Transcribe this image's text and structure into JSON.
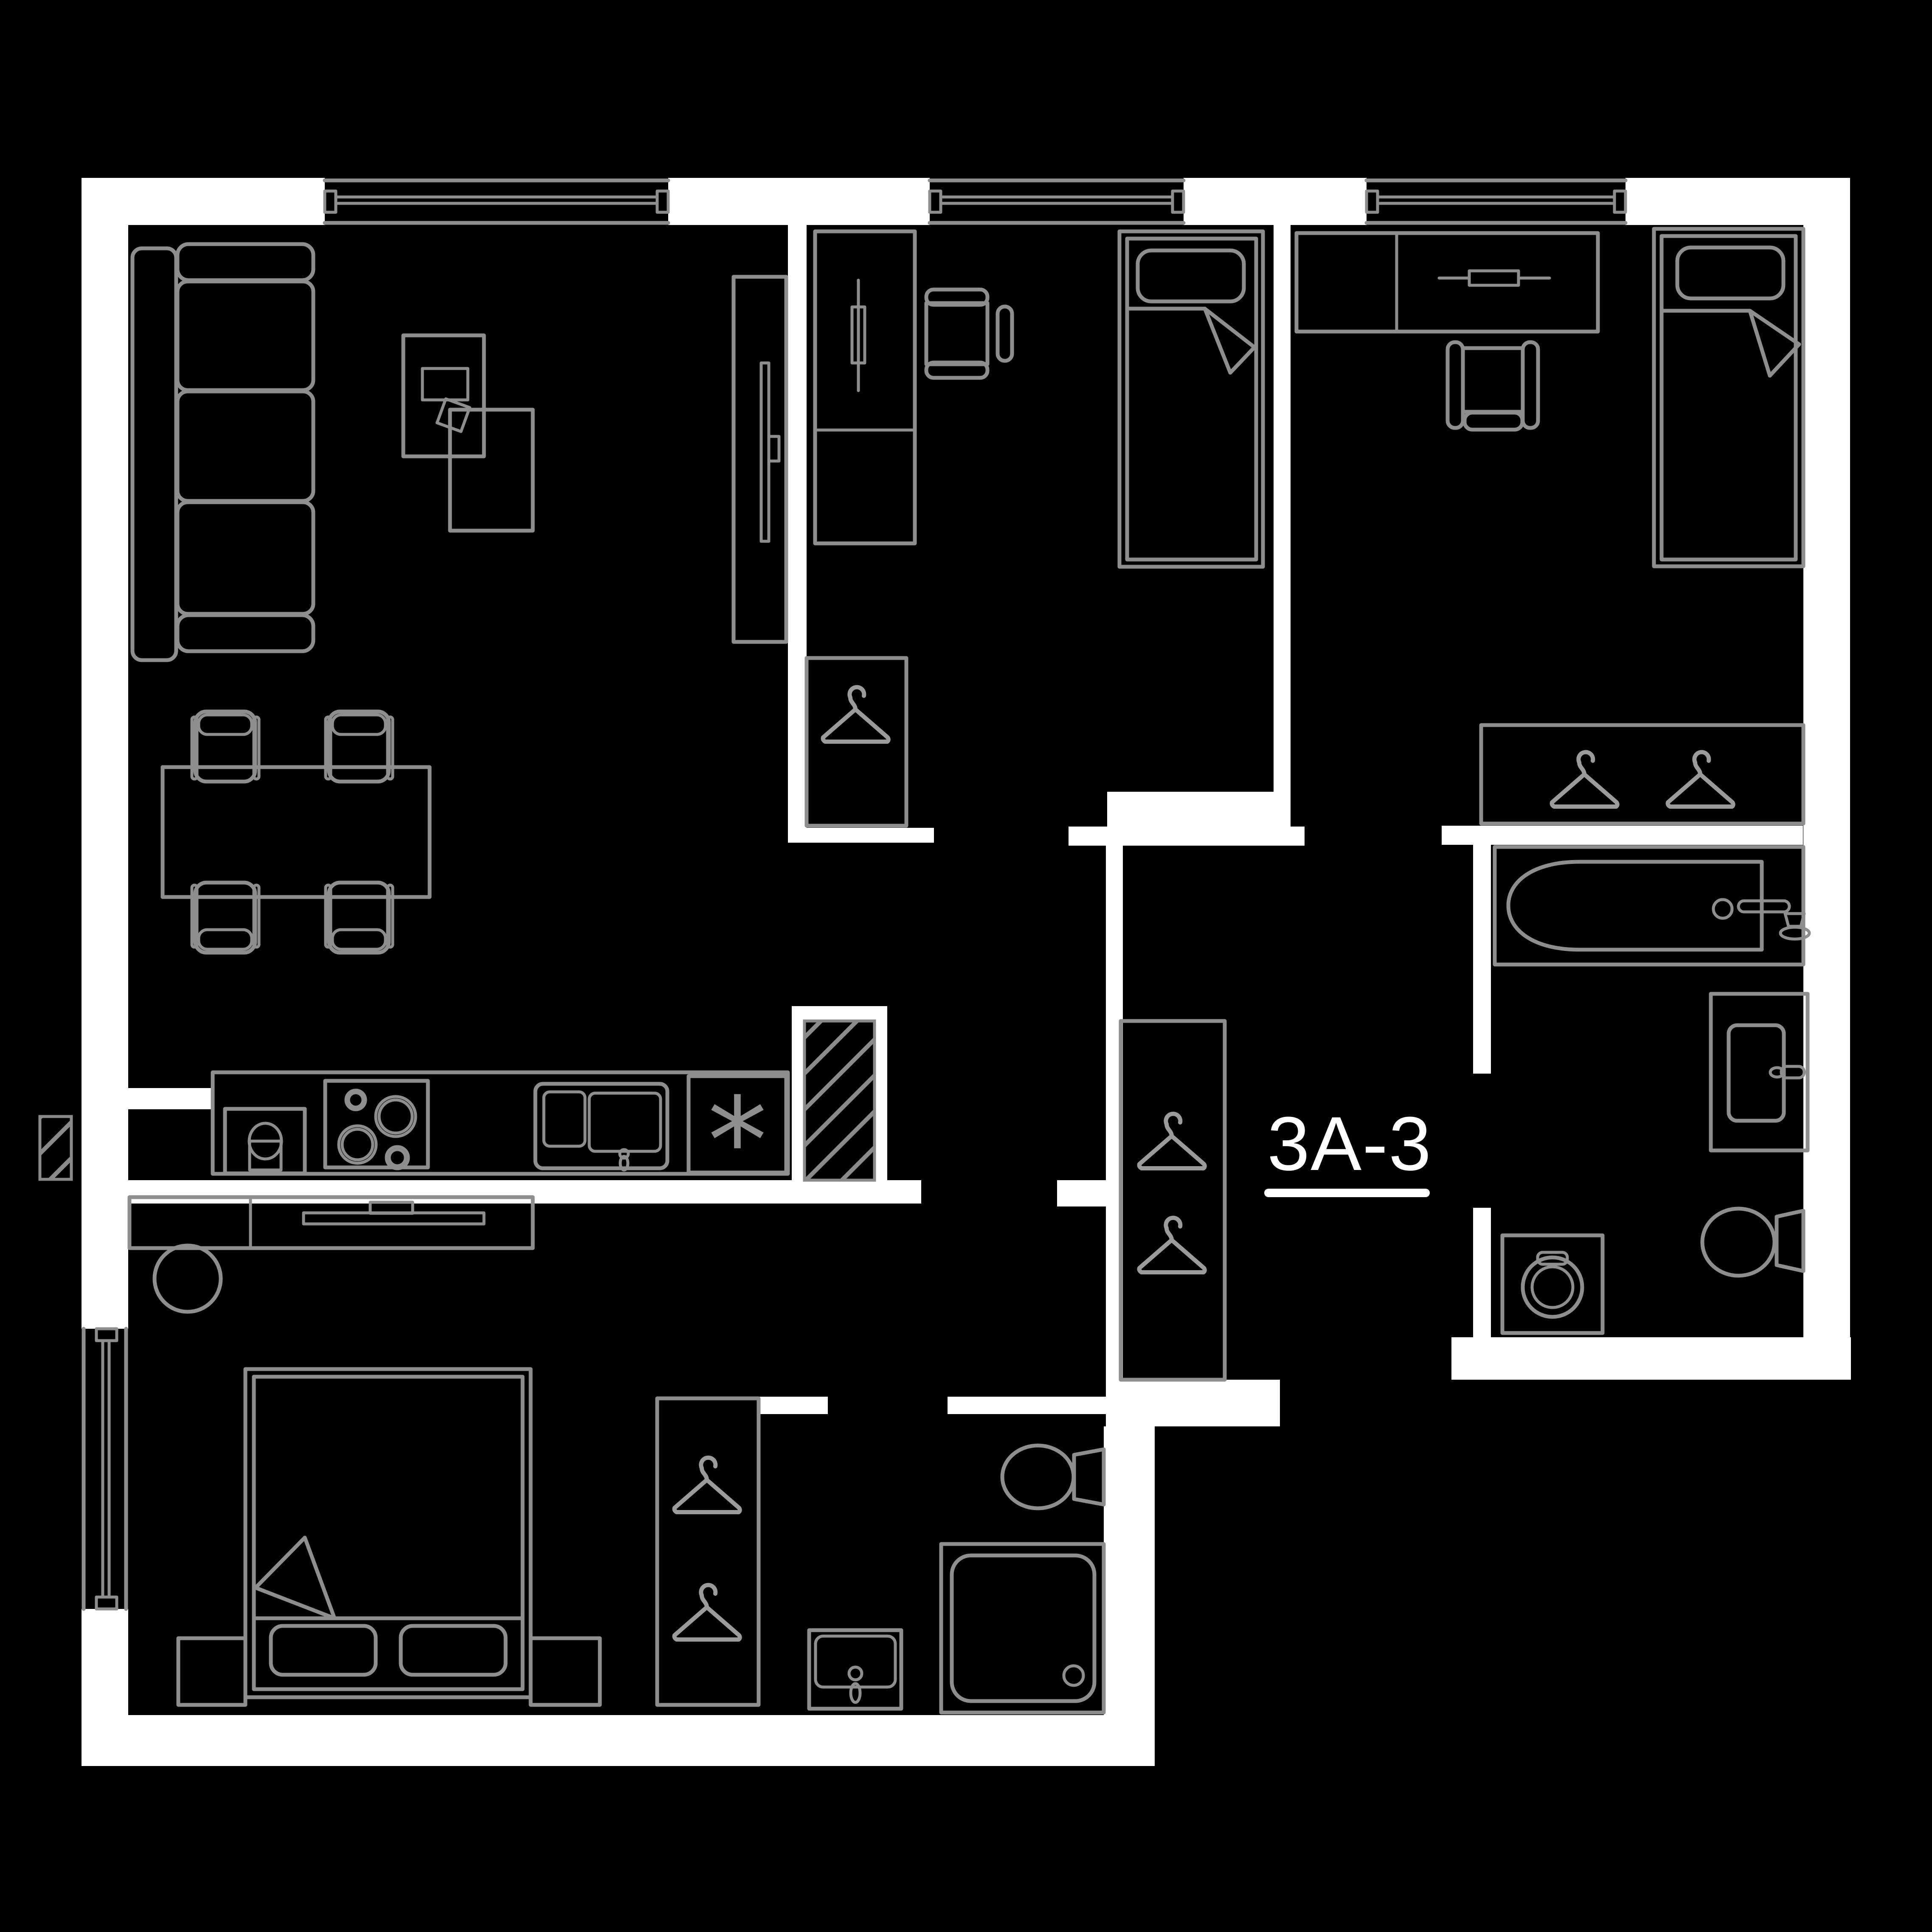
{
  "plan": {
    "unit_label": "3A-3",
    "fridge_symbol": "*"
  },
  "colors": {
    "background": "#000000",
    "wall": "#ffffff",
    "line": "#8e8e8e",
    "line_light": "#9b9b9b",
    "label_text": "#ffffff"
  },
  "icons": {
    "closet_marker": "hanger-icon",
    "fridge_marker": "asterisk-icon",
    "shaft_marker": "diagonal-hatch-icon"
  }
}
